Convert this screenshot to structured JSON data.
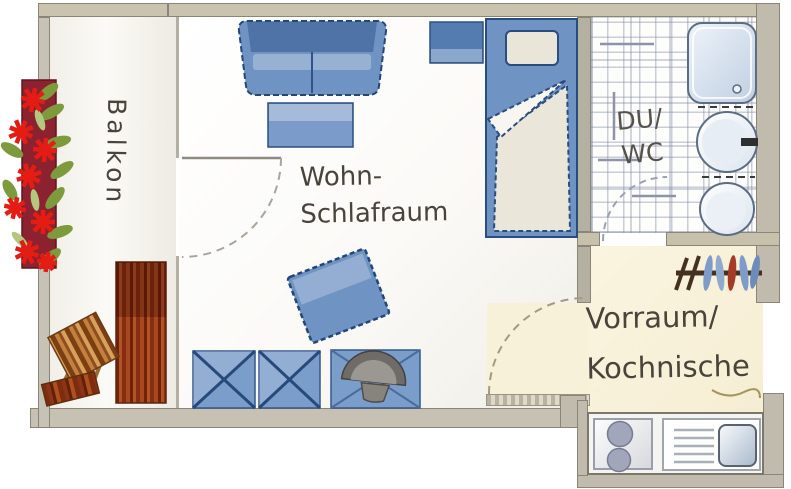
{
  "plan_type": "apartment floor plan",
  "rooms": {
    "balcony": {
      "label": "Balkon"
    },
    "living": {
      "label_line1": "Wohn-",
      "label_line2": "Schlafraum"
    },
    "bathroom": {
      "label_line1": "DU/",
      "label_line2": "WC"
    },
    "hall": {
      "label_line1": "Vorraum/",
      "label_line2": "Kochnische"
    }
  },
  "furniture": [
    "sofa",
    "coffee-table",
    "wall-shelf",
    "bed",
    "pillow",
    "duvet",
    "tilted-side-table",
    "folding-table-1",
    "folding-table-2",
    "table-with-armchair",
    "armchair",
    "wooden-chair",
    "sun-lounger",
    "flower-box",
    "coat-rack",
    "shower",
    "washbasin",
    "toilet",
    "kitchen-counter",
    "stove-two-burners",
    "kitchen-sink"
  ],
  "doors": [
    "balcony-door",
    "bathroom-door",
    "hall-door"
  ],
  "palette": {
    "wall_tan": "#cac4ae",
    "wall_gray": "#c0bbac",
    "wall_outline": "#8a8577",
    "hall_floor_cream": "#f8f1da",
    "furniture_blue": "#6f93c3",
    "furniture_blue_dark": "#24477a",
    "furniture_blue_light": "#a6bad9",
    "bedding_cream": "#eae7da",
    "wood_orange": "#c2813f",
    "wood_dark": "#7c3f12",
    "lounger_red_brown": "#a84820",
    "flower_red": "#e31d14",
    "leaf_green": "#7d9b3d",
    "tile_line": "#767f9e",
    "armchair_gray": "#6f6b66",
    "label_text": "#49443b"
  }
}
